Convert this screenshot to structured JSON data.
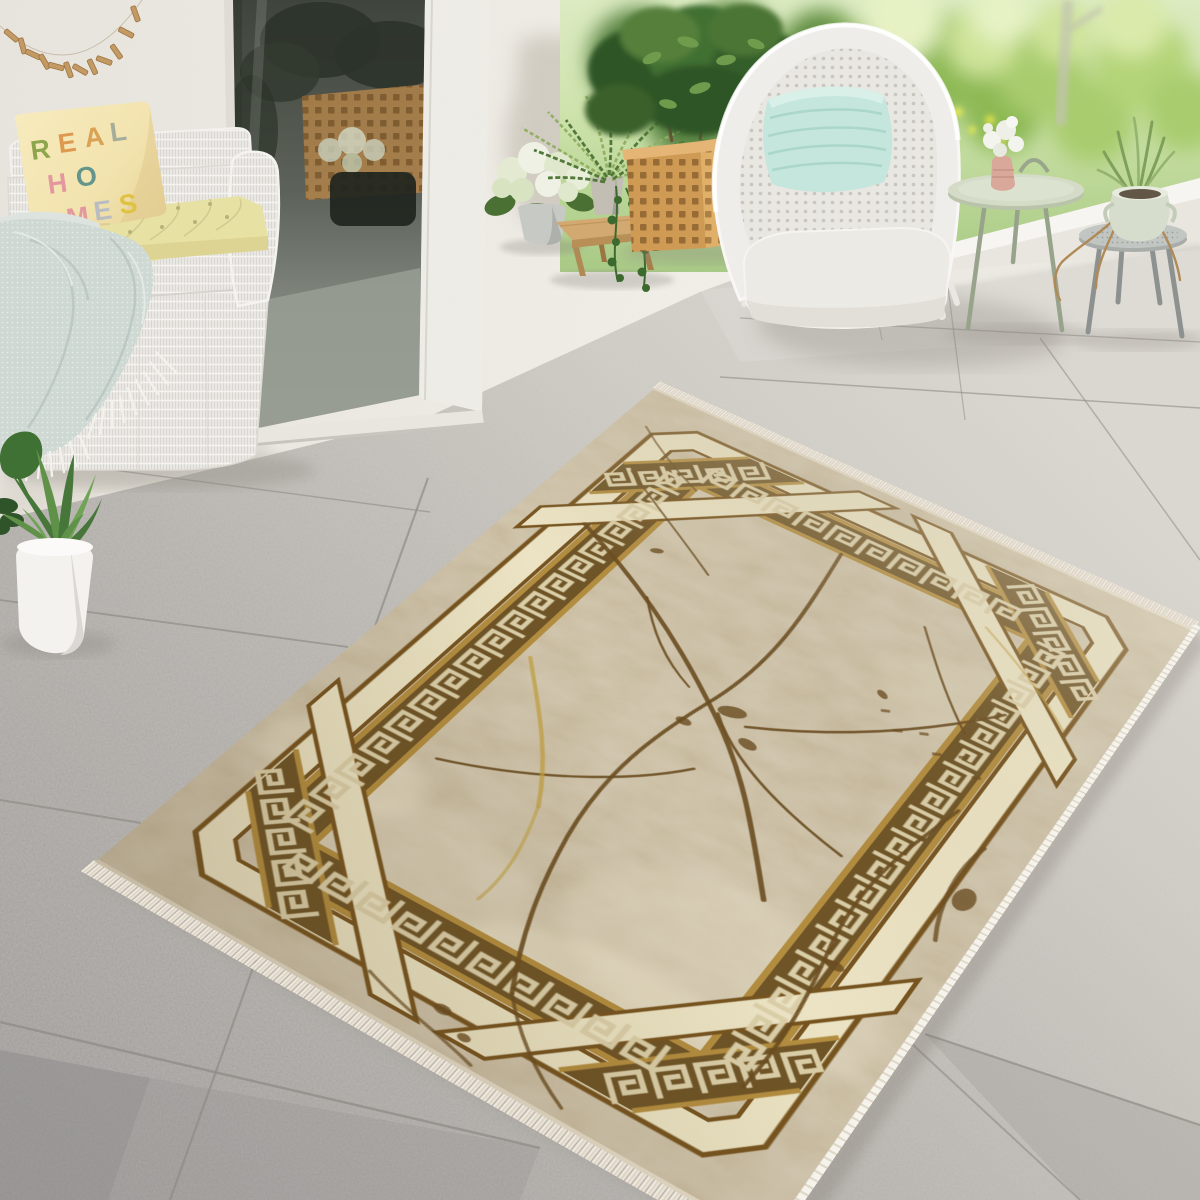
{
  "meta": {
    "title": "Sunny patio lifestyle photo: beige marble-pattern rug with Greek key border, white wicker furniture"
  },
  "scene": {
    "pillow": {
      "letters": [
        {
          "char": "R",
          "color": "#8ea64b"
        },
        {
          "char": "E",
          "color": "#dd9a4e"
        },
        {
          "char": "A",
          "color": "#d9a254"
        },
        {
          "char": "L",
          "color": "#a4ad9a"
        },
        {
          "char": "H",
          "color": "#e2989e"
        },
        {
          "char": "O",
          "color": "#64958d"
        },
        {
          "char": "M",
          "color": "#e2989e"
        },
        {
          "char": "E",
          "color": "#b9bdc2"
        },
        {
          "char": "S",
          "color": "#dfc23f"
        }
      ]
    },
    "palette": {
      "wall": "#ece8e1",
      "glass_dark": "#3f453c",
      "floor_light": "#d8d4cd",
      "floor_dark": "#9a9794",
      "garden_green": "#b7d492",
      "wicker_white": "#eceae5",
      "cushion_yellow": "#e8e1a4",
      "pillow_yellow": "#f2e3ae",
      "blanket_mint": "#cfd9d3",
      "chair_pillow_mint": "#c4e6dd",
      "planter_wood": "#d9a660",
      "table_sage": "#cfd8c4",
      "stool_gray": "#b9bdb9",
      "vase_pink": "#d9a89a",
      "pot_celadon": "#d6ddcc",
      "pot_white": "#f4f2ee"
    }
  },
  "rug": {
    "flat_size": [
      640,
      920
    ],
    "corners": {
      "n": [
        655,
        388
      ],
      "e": [
        1192,
        628
      ],
      "s": [
        765,
        1242
      ],
      "w": [
        95,
        862
      ]
    },
    "colors": {
      "field": "#c6b89a",
      "field_light": "#ded5bc",
      "cream": "#ebe3c3",
      "band": "#6e5426",
      "gold": "#b38d3f",
      "line": "#77541f",
      "motif": "#dbcfa9",
      "vein": "#6a4c20",
      "vein_gold": "#c2a040",
      "edge": "#e6ddc9"
    },
    "bands": {
      "cream": [
        42,
        74
      ],
      "key": [
        80,
        128
      ],
      "cut_cream": 120,
      "cut_key": 190,
      "ribbon": [
        285,
        330
      ],
      "motif_step": 37
    },
    "veins": [
      {
        "d": "M70,260 C150,300 230,350 320,430 C380,482 420,540 470,610",
        "w": 5
      },
      {
        "d": "M300,130 C312,220 330,320 305,420 C288,492 278,560 295,650 C305,700 320,760 355,830",
        "w": 4
      },
      {
        "d": "M540,250 C490,320 430,380 350,425",
        "w": 3.5
      },
      {
        "d": "M320,425 C360,470 420,500 500,520",
        "w": 3
      },
      {
        "d": "M150,640 C230,610 300,560 340,505",
        "w": 3
      },
      {
        "d": "M560,400 C545,470 525,540 545,640 C553,690 560,740 555,800",
        "w": 3.5
      },
      {
        "d": "M60,150 C110,185 160,215 210,250",
        "w": 2.5,
        "o": 0.8
      },
      {
        "d": "M420,180 C450,220 480,260 520,300",
        "w": 2.5
      },
      {
        "d": "M180,320 C210,360 240,390 280,410",
        "w": 2.5
      },
      {
        "d": "M355,830 C380,860 410,885 450,905",
        "w": 3,
        "o": 0.8
      },
      {
        "d": "M30,70 C60,95 90,115 130,135",
        "w": 2.5,
        "o": 0.7
      },
      {
        "d": "M600,430 C590,470 596,520 612,560",
        "w": 4,
        "o": 0.8
      },
      {
        "d": "M250,880 C290,895 330,900 370,912",
        "w": 3,
        "o": 0.7
      },
      {
        "d": "M140,470 C180,520 225,570 255,635",
        "w": 4,
        "g": 1,
        "o": 0.75
      },
      {
        "d": "M255,635 C270,680 280,720 275,760",
        "w": 3,
        "g": 1,
        "o": 0.6
      },
      {
        "d": "M470,140 C510,165 555,195 595,235",
        "w": 3,
        "g": 1,
        "o": 0.55
      }
    ],
    "blotches": [
      [
        330,
        415,
        14,
        8,
        -20
      ],
      [
        363,
        445,
        10,
        6,
        10
      ],
      [
        300,
        455,
        8,
        5,
        0
      ],
      [
        432,
        300,
        7,
        4,
        30
      ],
      [
        555,
        640,
        9,
        5,
        0
      ],
      [
        612,
        500,
        10,
        15,
        0
      ],
      [
        320,
        878,
        8,
        5,
        0
      ],
      [
        350,
        892,
        6,
        4,
        0
      ],
      [
        150,
        250,
        7,
        4,
        -30
      ]
    ],
    "marks": [
      [
        440,
        320
      ],
      [
        462,
        338
      ],
      [
        484,
        326
      ],
      [
        506,
        344
      ],
      [
        528,
        332
      ],
      [
        550,
        350
      ]
    ],
    "patches": [
      [
        480,
        700,
        150,
        90,
        "#e0d7bf",
        0.5
      ],
      [
        200,
        760,
        120,
        70,
        "#e0d7bf",
        0.45
      ],
      [
        520,
        260,
        110,
        60,
        "#ddd4ba",
        0.4
      ],
      [
        150,
        180,
        90,
        50,
        "#d8cfb5",
        0.4
      ],
      [
        420,
        800,
        130,
        60,
        "#efe7cd",
        0.45
      ],
      [
        90,
        700,
        80,
        50,
        "#efe7cd",
        0.4
      ],
      [
        320,
        70,
        200,
        45,
        "#b3a88c",
        0.3
      ]
    ]
  }
}
